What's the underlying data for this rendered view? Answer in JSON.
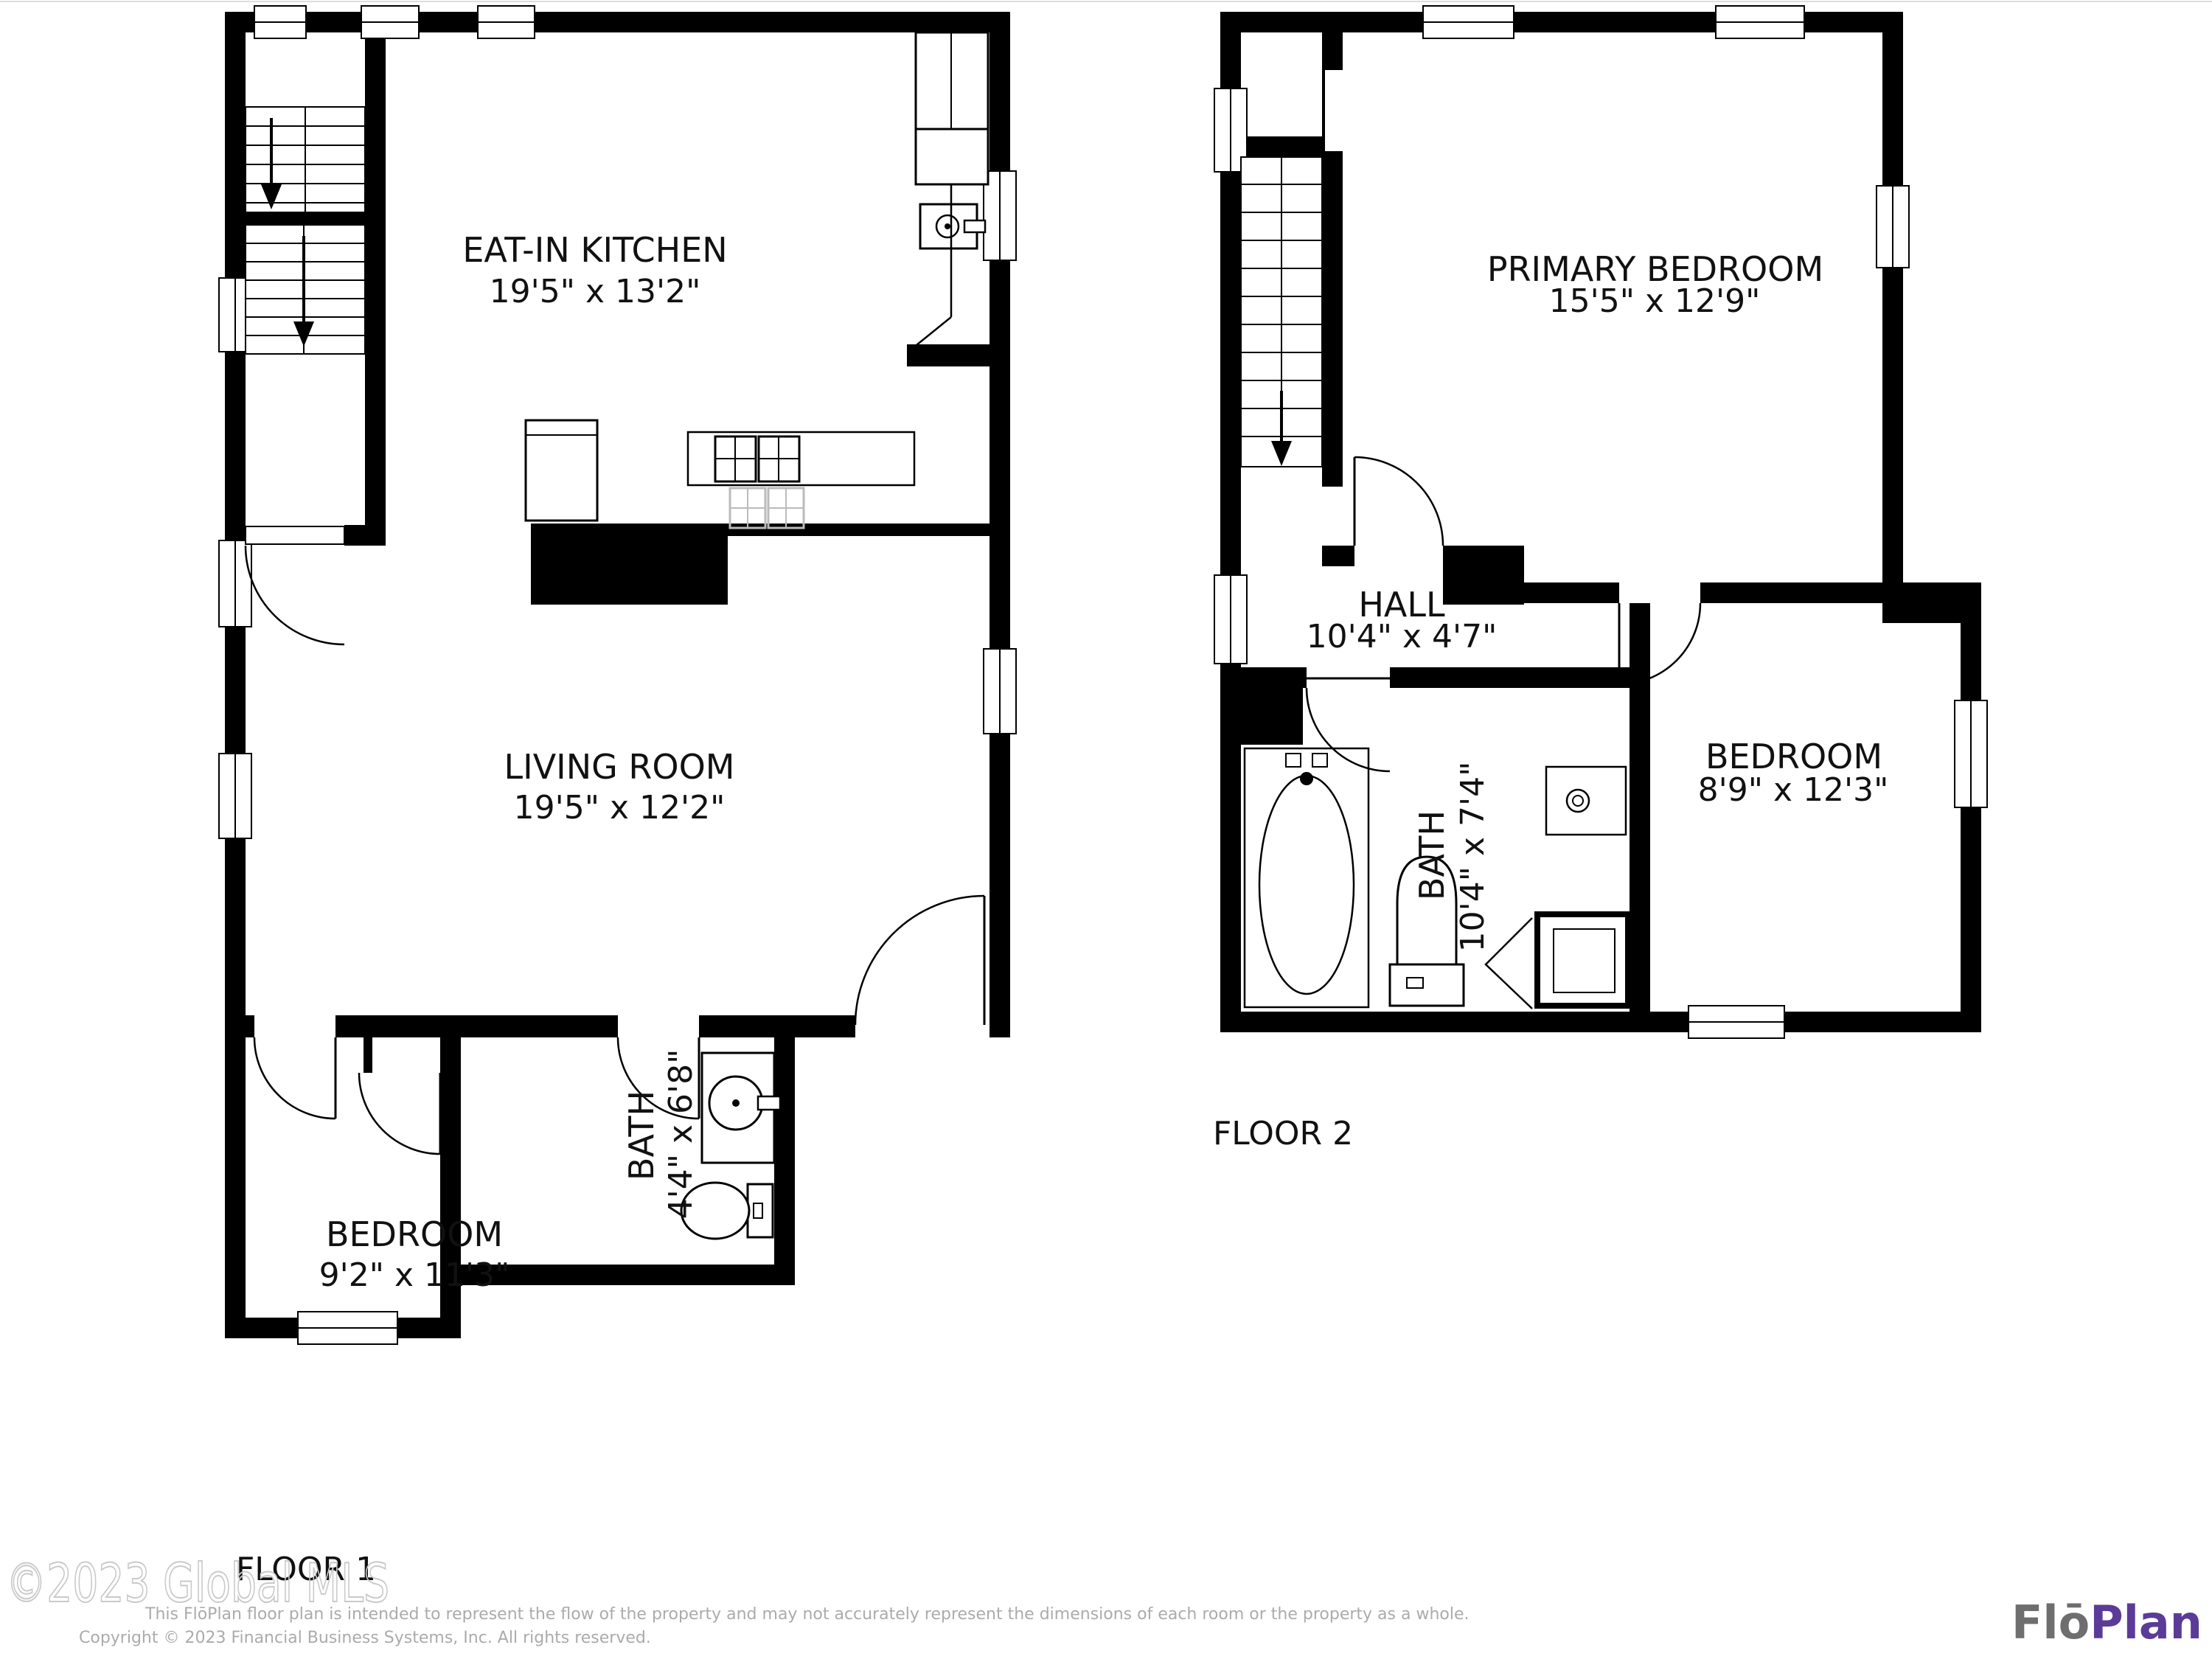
{
  "floors": [
    {
      "label": "FLOOR 1",
      "rooms": [
        {
          "name": "EAT-IN KITCHEN",
          "dims": "19'5\" x 13'2\""
        },
        {
          "name": "LIVING ROOM",
          "dims": "19'5\" x 12'2\""
        },
        {
          "name": "BEDROOM",
          "dims": "9'2\" x 11'3\""
        },
        {
          "name": "BATH",
          "dims": "4'4\" x 6'8\""
        }
      ]
    },
    {
      "label": "FLOOR 2",
      "rooms": [
        {
          "name": "PRIMARY BEDROOM",
          "dims": "15'5\" x 12'9\""
        },
        {
          "name": "HALL",
          "dims": "10'4\" x 4'7\""
        },
        {
          "name": "BATH",
          "dims": "10'4\" x 7'4\""
        },
        {
          "name": "BEDROOM",
          "dims": "8'9\" x 12'3\""
        }
      ]
    }
  ],
  "watermark": "©2023 Global MLS",
  "footer": {
    "disclaimer": "This FlōPlan floor plan is intended to represent the flow of the property and may not accurately represent the dimensions of each room or the property as a whole.",
    "copyright": "Copyright © 2023 Financial Business Systems, Inc. All rights reserved."
  },
  "logo": {
    "part1": "Flō",
    "part2": "Plan",
    "color1": "#6e6e6e",
    "color2": "#5b3b97"
  },
  "colors": {
    "walls": "#000000",
    "reflection": "#bbbbbb",
    "watermark": "#c9c9c9",
    "disclaimer": "#ababab"
  }
}
